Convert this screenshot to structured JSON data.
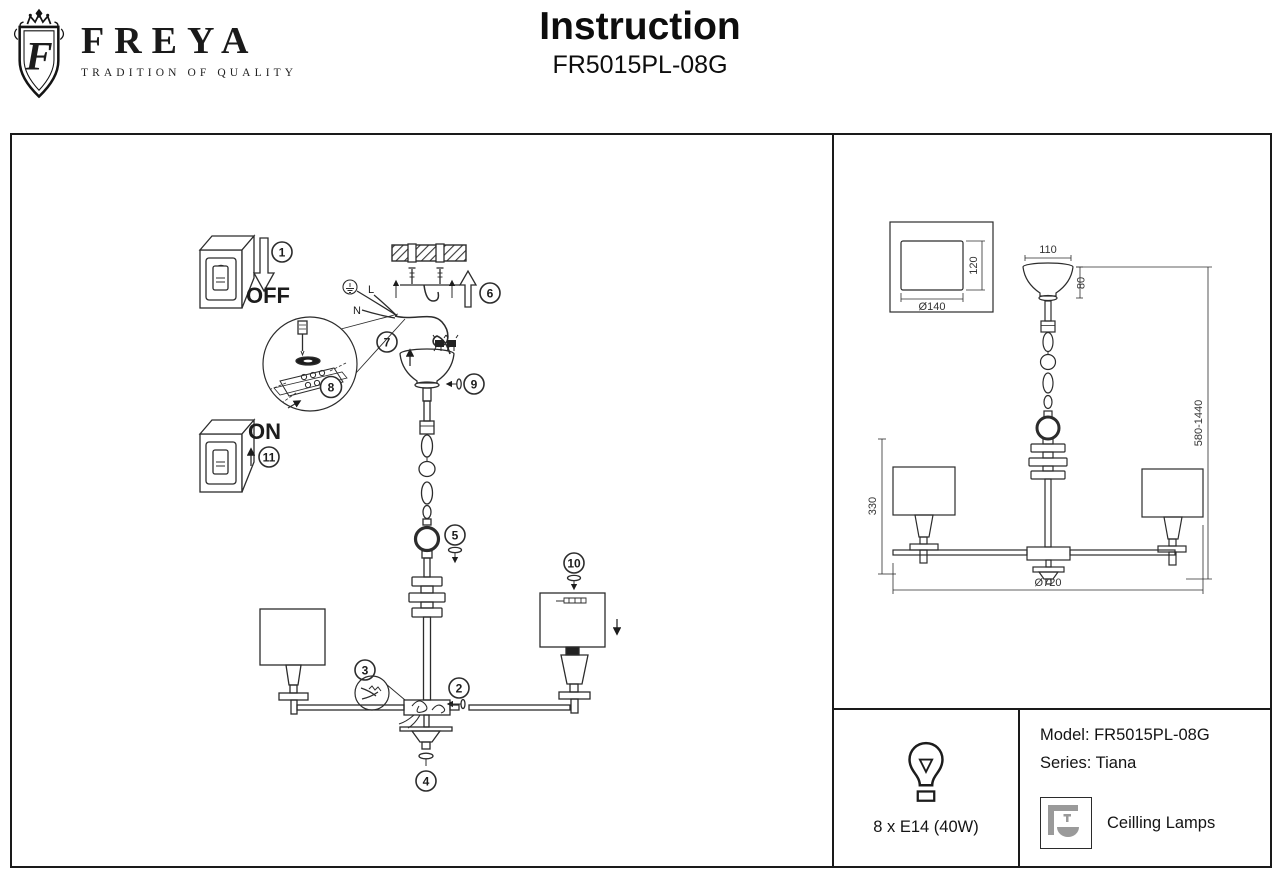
{
  "header": {
    "brand": "FREYA",
    "monogram": "F",
    "tagline": "TRADITION OF QUALITY",
    "title": "Instruction",
    "model": "FR5015PL-08G"
  },
  "assembly": {
    "off_label": "OFF",
    "on_label": "ON",
    "wire_l": "L",
    "wire_n": "N",
    "steps": [
      "1",
      "2",
      "3",
      "4",
      "5",
      "6",
      "7",
      "8",
      "9",
      "10",
      "11"
    ]
  },
  "dimensions": {
    "canopy_width": "110",
    "canopy_height": "80",
    "bracket_depth": "120",
    "bracket_diameter": "Ø140",
    "height_range": "580-1440",
    "body_height": "330",
    "diameter": "Ø720"
  },
  "product": {
    "model": "Model: FR5015PL-08G",
    "series": "Series: Tiana",
    "lamps": "8 x E14 (40W)",
    "category": "Ceilling Lamps"
  }
}
